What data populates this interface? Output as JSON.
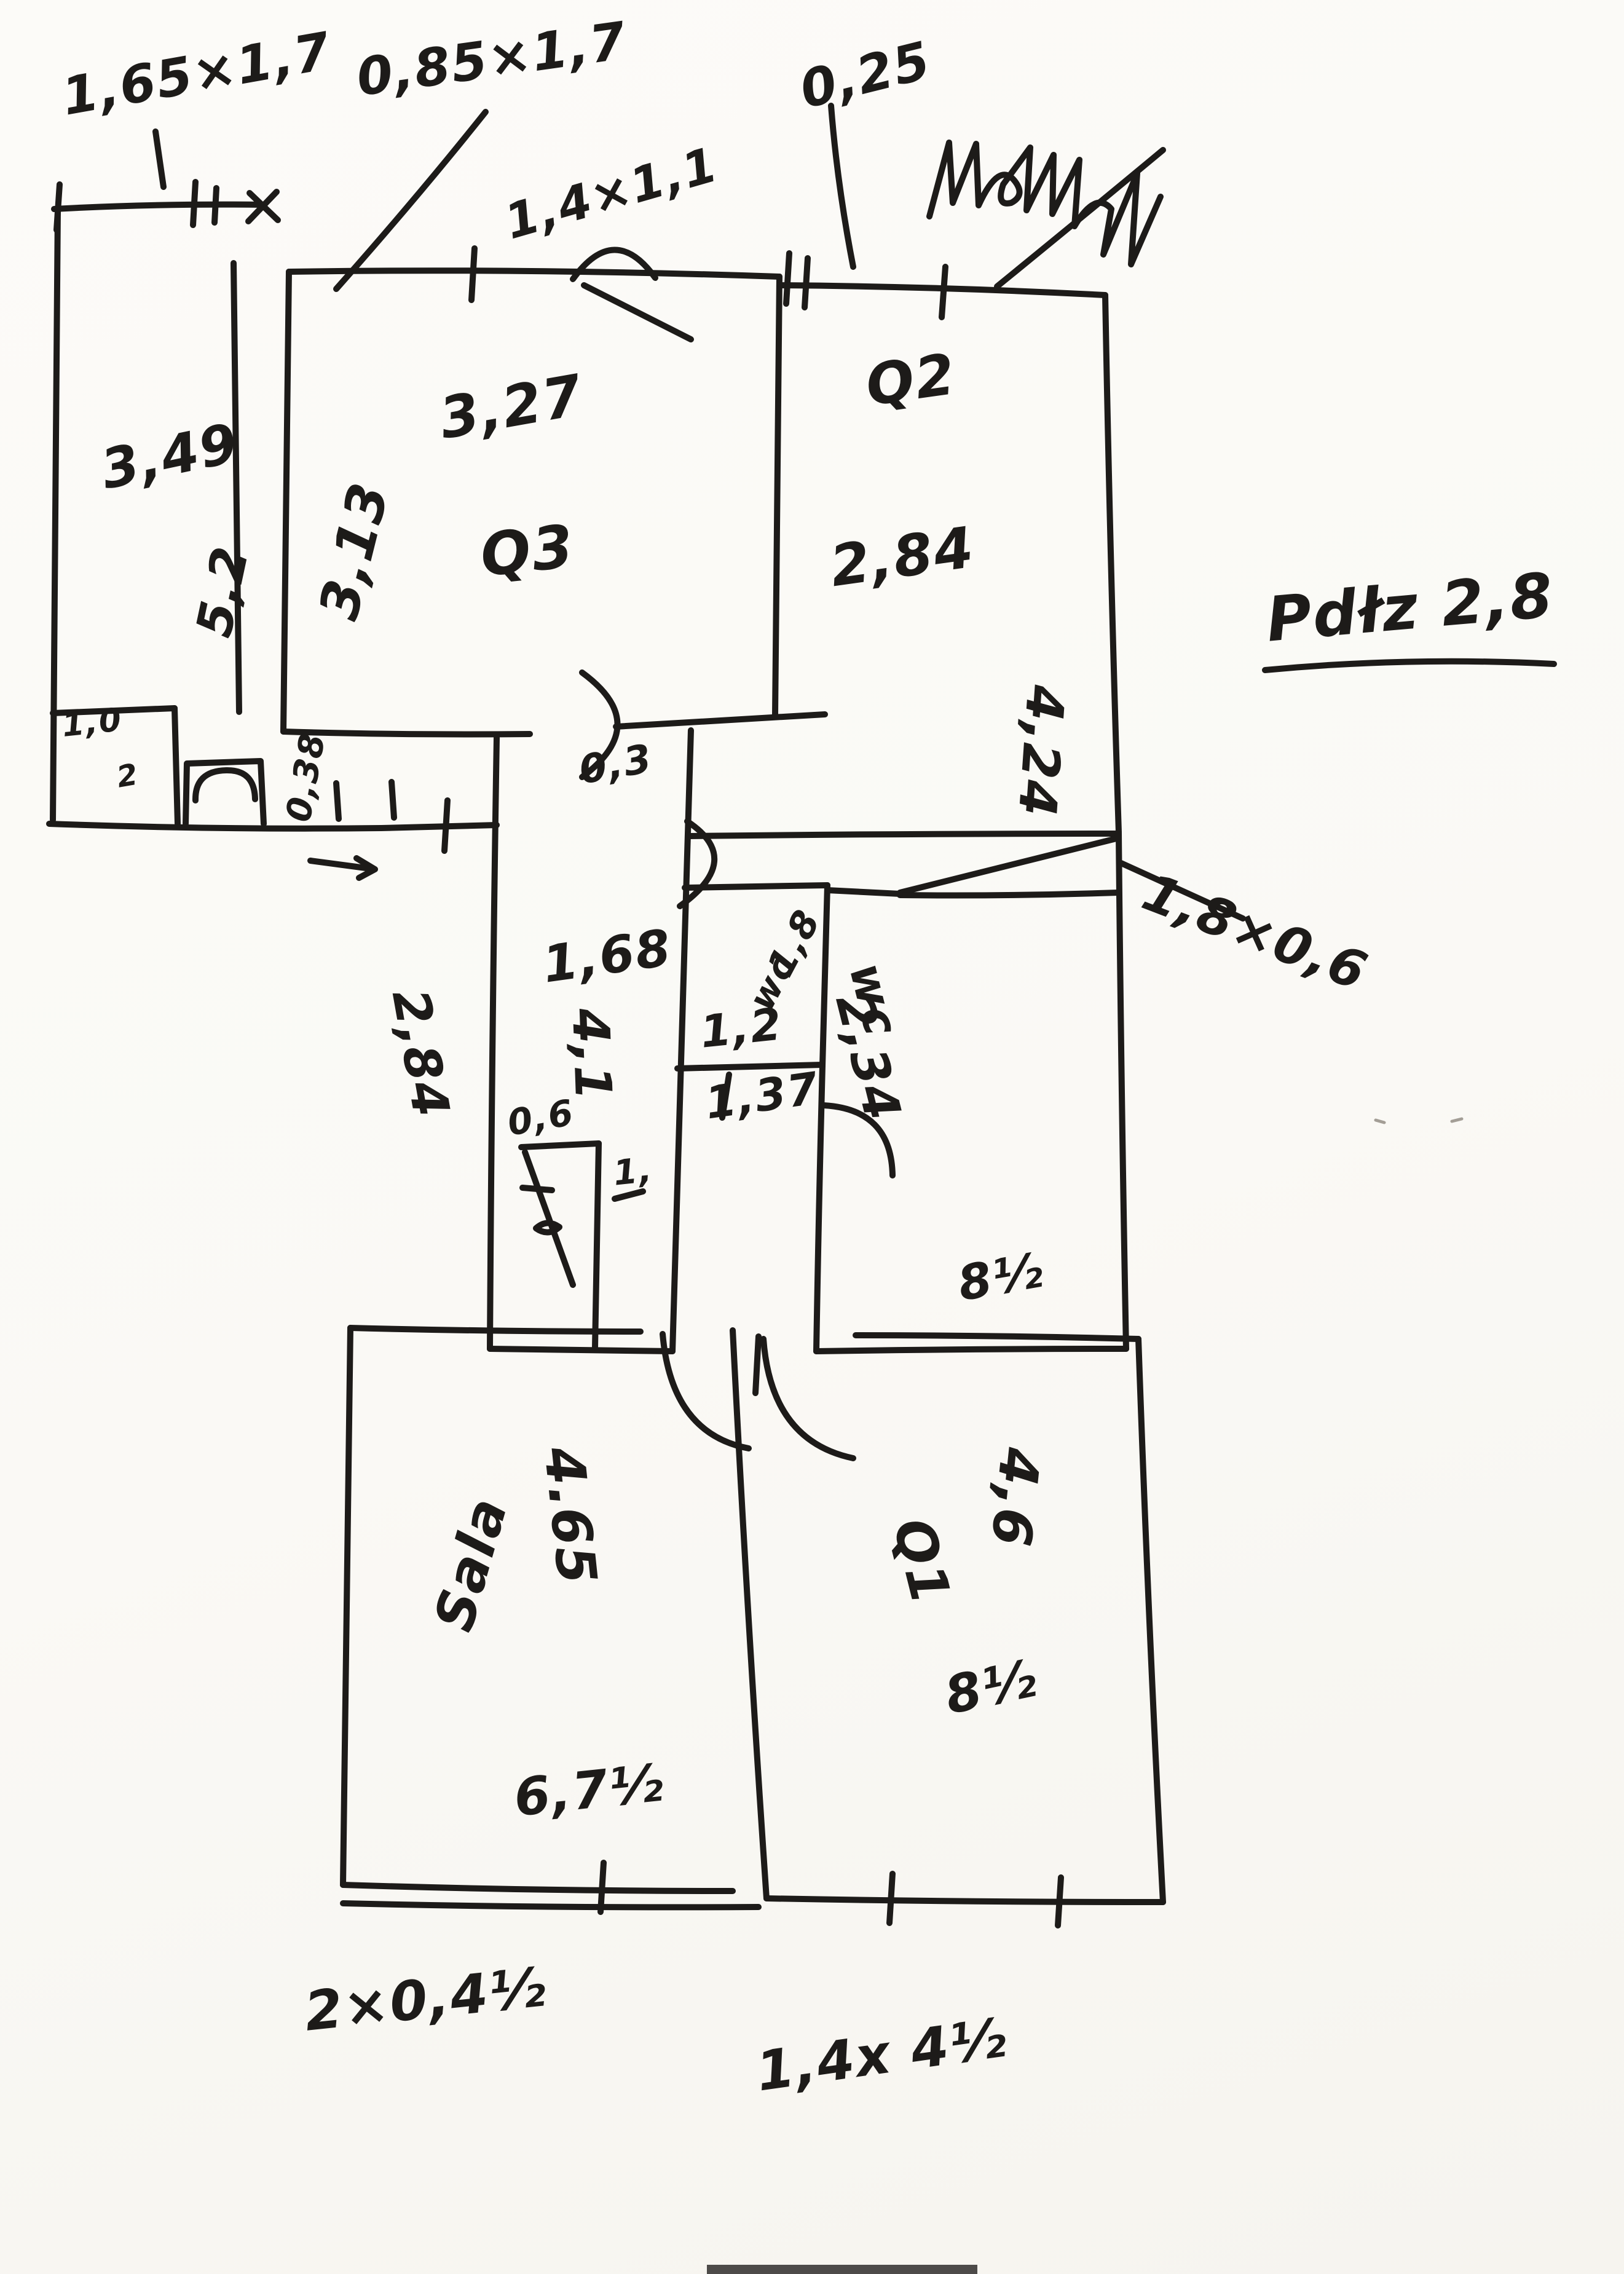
{
  "meta": {
    "kind": "hand-drawn floor plan sketch",
    "medium": "black ink pen on white paper",
    "paper_color": "#fbfaf7",
    "ink_color": "#1d1b19",
    "illegible_scribble_present": "cursive word top-right (unreadable)"
  },
  "labels": {
    "win_left": "1,65×1,7",
    "win_left2": "0,85×1,7",
    "win_mid": "1,4×1,1",
    "wall_depth": "0,25",
    "room1_width": "3,49",
    "room1_height": "5,2",
    "room1_alcove": "1,0",
    "room1_alcove2": "2",
    "room2_width": "3,27",
    "room2_name": "Q3",
    "room2_height": "3,13",
    "room3_name": "Q2",
    "room3_width": "2,84",
    "room3_height": "4,24",
    "note_height": "Pdłz 2,8",
    "hall_width": "1,68",
    "hall_height": "4,1",
    "hall_dim_left": "2,84",
    "dim_038": "0,38",
    "dim_03": "0,3",
    "wc1_dim": "1,8",
    "wc1_name": "wc",
    "wc1_width": "1,2",
    "wc1_depth": "1,37",
    "wc2_name": "wc",
    "wc2_height": "2,34",
    "wc2_area": "8½",
    "wardrobe": "1,8×0,6",
    "closet_width": "0,6",
    "closet_note": "1,",
    "sala_name": "Sala",
    "sala_width": "4.65",
    "sala_dim": "6,7½",
    "room4_height": "4,6",
    "room4_name": "Q1",
    "room4_area": "8½",
    "win_bottom_left": "2×0,4½",
    "win_bottom_right": "1,4x 4½"
  }
}
